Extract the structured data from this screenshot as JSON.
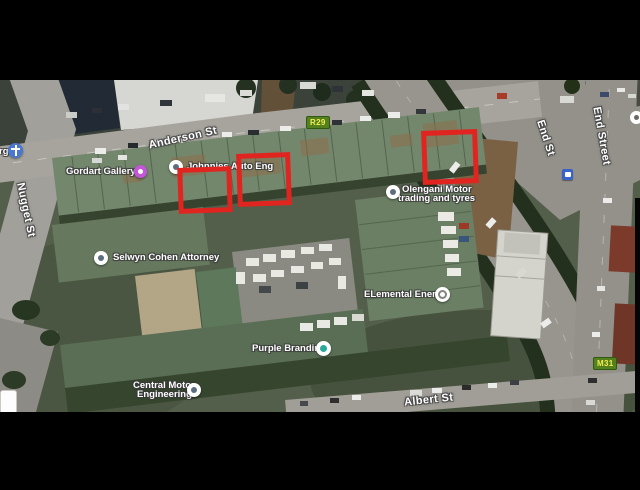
{
  "scene": {
    "description": "Letterboxed satellite map screenshot of a city block with three red annotation rectangles",
    "letterbox_color": "#000000",
    "annotation_color": "#e02420",
    "annotation_count": 3
  },
  "map": {
    "type": "satellite",
    "streets": {
      "anderson": "Anderson St",
      "nugget": "Nugget St",
      "end_st": "End St",
      "end_street": "End Street",
      "albert": "Albert St"
    },
    "badges": {
      "r29": "R29",
      "m31": "M31",
      "background": "#55801e",
      "text_color": "#f2ee52"
    },
    "places": {
      "edge_partial": "rg",
      "gordart": "Gordart Gallery",
      "johnnies": "Johnnies Auto Eng",
      "olengani_1": "Olengani Motor",
      "olengani_2": "trading and tyres",
      "selwyn": "Selwyn Cohen Attorney",
      "elemental": "ELemental Energy",
      "purple": "Purple Branding",
      "central_1": "Central Motor",
      "central_2": "Engineering"
    },
    "icons": [
      "church-icon",
      "gallery-icon",
      "place-icon",
      "place-icon",
      "pin-icon",
      "business-ring-icon",
      "business-teal-icon",
      "pin-icon",
      "bus-station-icon",
      "partial-place-icon"
    ]
  }
}
